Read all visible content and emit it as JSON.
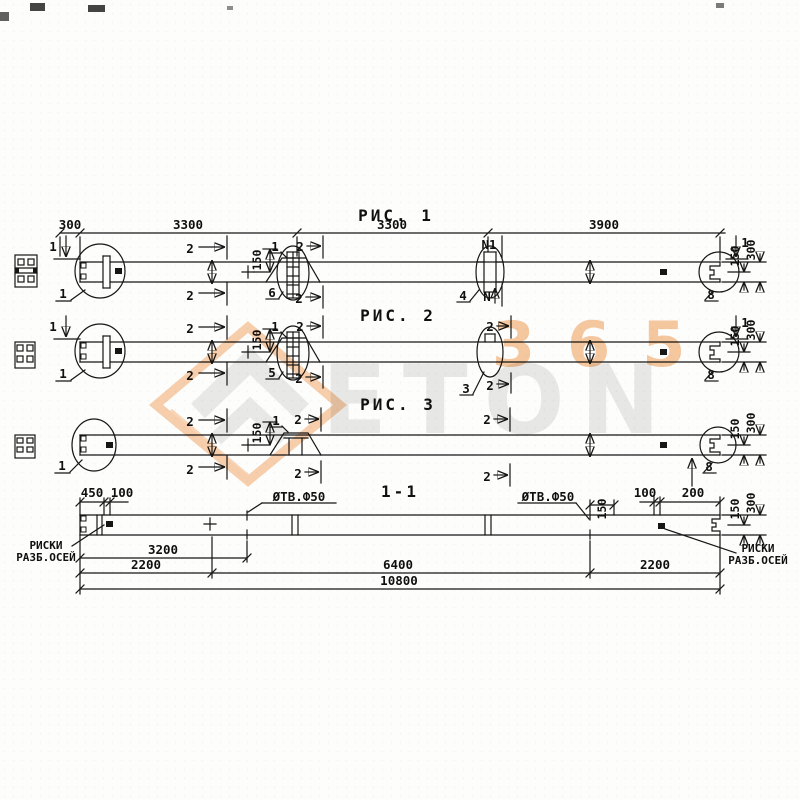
{
  "watermark": {
    "digits": "365",
    "word": "ETON"
  },
  "fig1": {
    "title": "РИС. 1",
    "d300": "300",
    "d3300a": "3300",
    "d3300b": "3300",
    "d3900": "3900",
    "s1": "1",
    "s2": "2",
    "n1": "N1",
    "n": "N",
    "k150": "150",
    "r150": "150",
    "r300": "300",
    "det1": "1",
    "det6": "6",
    "det4": "4",
    "det8": "8",
    "m1": "1"
  },
  "fig2": {
    "title": "РИС. 2",
    "s1": "1",
    "s2": "2",
    "k150": "150",
    "r150": "150",
    "r300": "300",
    "det1": "1",
    "det5": "5",
    "det3": "3",
    "det8": "8",
    "m1": "1"
  },
  "fig3": {
    "title": "РИС. 3",
    "s2": "2",
    "k150": "150",
    "r150": "150",
    "r300": "300",
    "det1": "1",
    "det8": "8",
    "m1": "1"
  },
  "section": {
    "title": "1-1",
    "d450": "450",
    "d100l": "100",
    "d100r": "100",
    "d200": "200",
    "d150": "150",
    "r150": "150",
    "r300": "300",
    "hole_left": "ØТВ.Ф50",
    "hole_right": "ØТВ.Ф50",
    "d3200": "3200",
    "d2200l": "2200",
    "d6400": "6400",
    "d2200r": "2200",
    "d10800": "10800",
    "risk_left_1": "РИСКИ",
    "risk_left_2": "РАЗБ.ОСЕЙ",
    "risk_right_1": "РИСКИ",
    "risk_right_2": "РАЗБ.ОСЕЙ"
  }
}
